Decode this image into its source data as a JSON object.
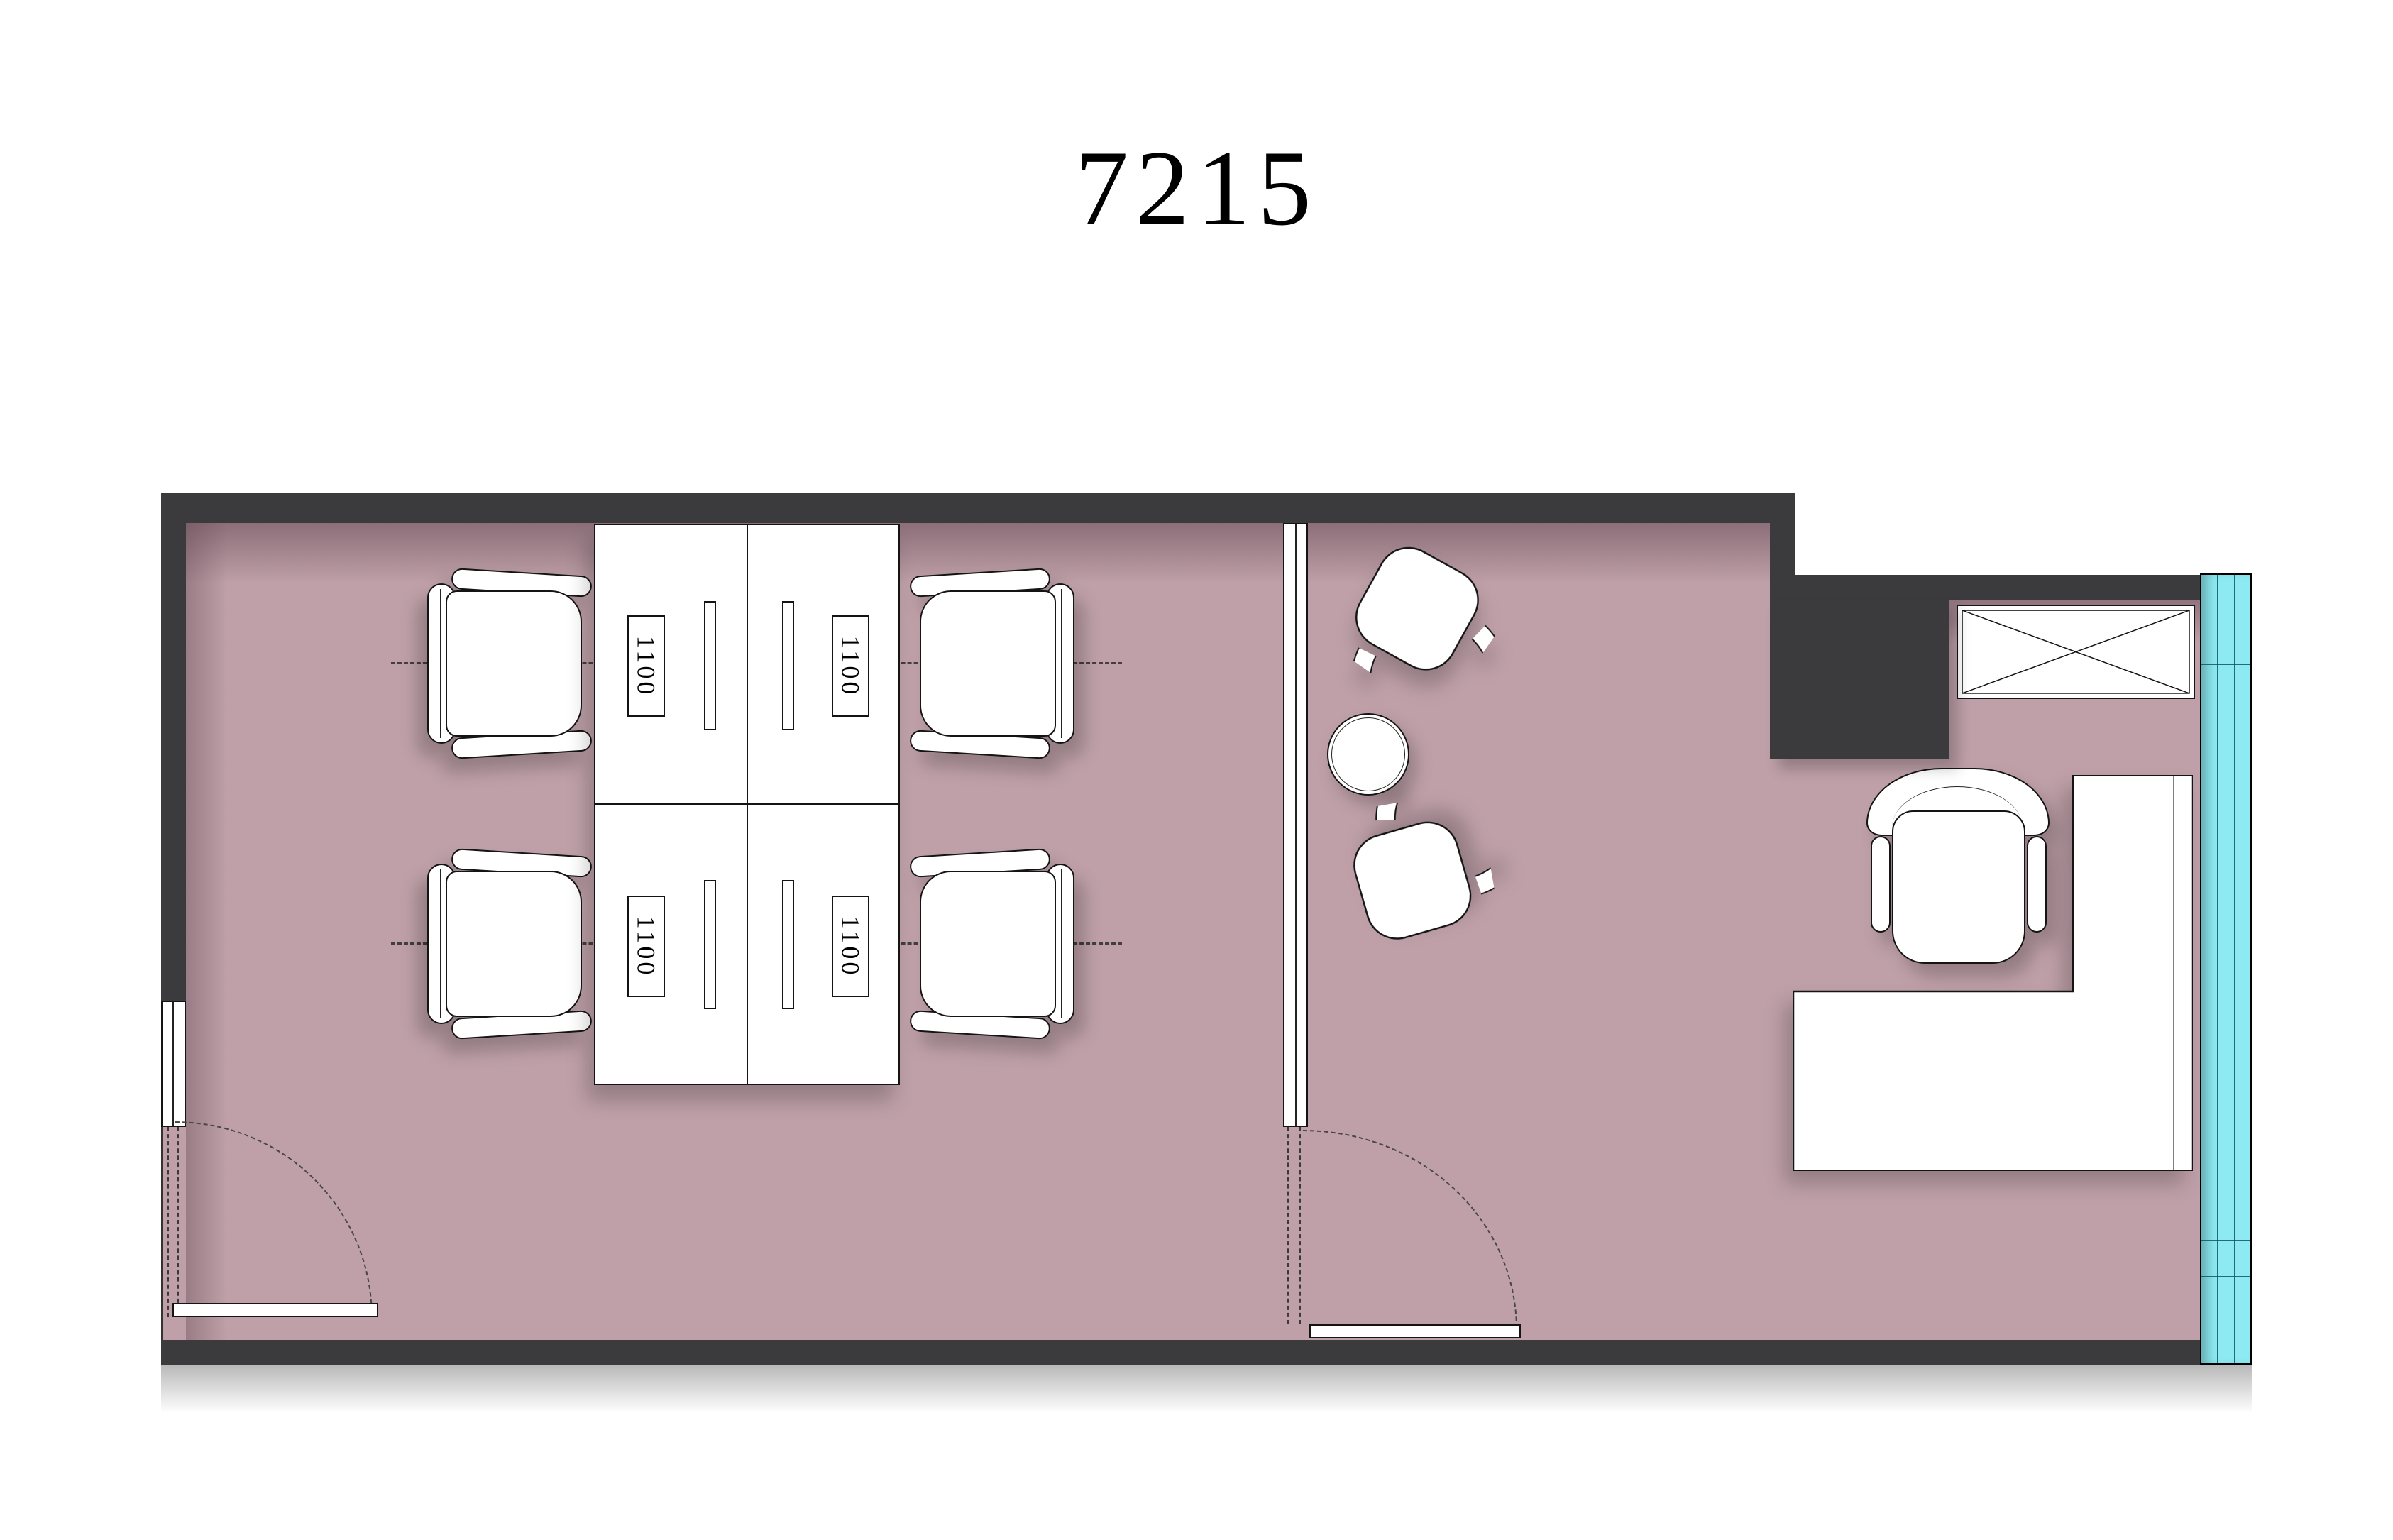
{
  "title": "7215",
  "colors": {
    "paper": "#ffffff",
    "wall": "#3b3b3d",
    "floor": "#bfa0a9",
    "glazing": "#8deaf3",
    "line": "#141414",
    "shadow": "rgba(0,0,0,0.22)"
  },
  "workstations": {
    "labels": [
      "1100",
      "1100",
      "1100",
      "1100"
    ]
  },
  "furniture": [
    "desk-cluster",
    "task-chair",
    "task-chair",
    "task-chair",
    "task-chair",
    "lounge-chair",
    "lounge-chair",
    "round-side-table",
    "executive-desk",
    "office-chair",
    "storage-cabinet",
    "structural-column"
  ]
}
